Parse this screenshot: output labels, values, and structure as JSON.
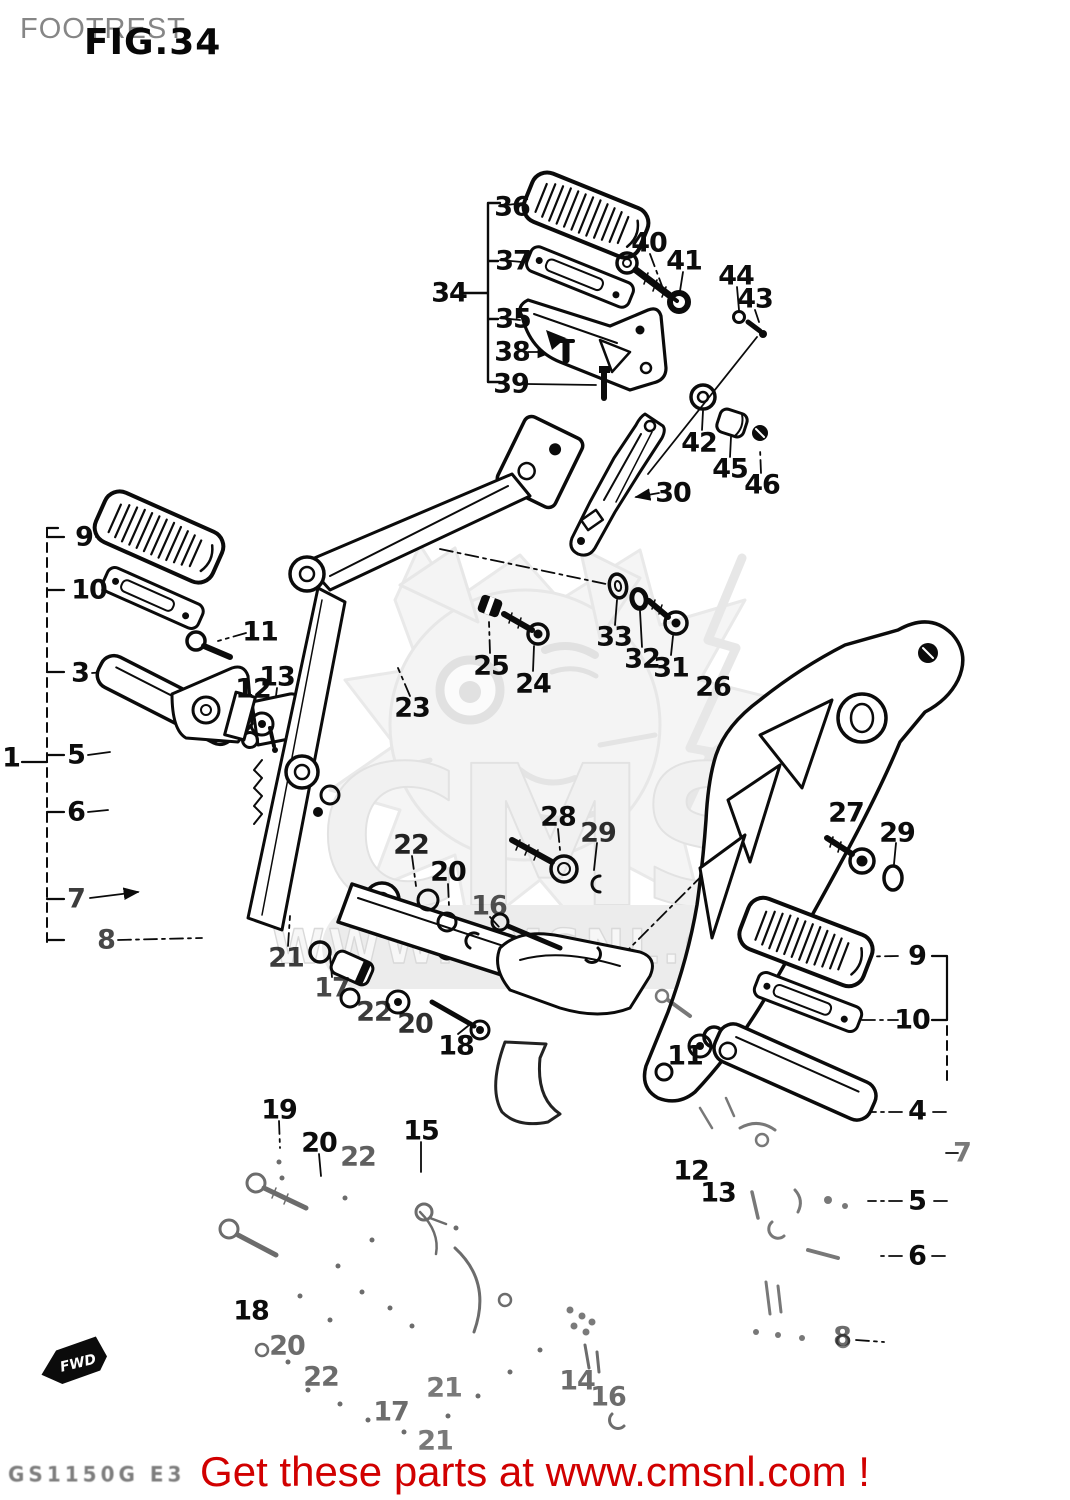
{
  "page": {
    "width": 1070,
    "height": 1500,
    "background": "#ffffff",
    "ink_color": "#0b0b0b"
  },
  "header": {
    "title": "FOOTREST",
    "figure": "FIG.34"
  },
  "watermark": {
    "logo_text": "CMS",
    "url_text": "WWW.CMSNL.COM",
    "color": "#e7e7e7"
  },
  "footer": {
    "fwd_label": "FWD",
    "model_code": "GS1150G E3",
    "promo_text": "Get these parts at www.cmsnl.com !",
    "promo_color": "#d10000"
  },
  "callouts": [
    {
      "label": "36",
      "x": 512,
      "y": 207,
      "o": 1
    },
    {
      "label": "37",
      "x": 513,
      "y": 261,
      "o": 1
    },
    {
      "label": "34",
      "x": 449,
      "y": 293,
      "o": 1
    },
    {
      "label": "35",
      "x": 513,
      "y": 319,
      "o": 1
    },
    {
      "label": "38",
      "x": 512,
      "y": 352,
      "o": 1
    },
    {
      "label": "39",
      "x": 511,
      "y": 384,
      "o": 1
    },
    {
      "label": "40",
      "x": 649,
      "y": 243,
      "o": 1
    },
    {
      "label": "41",
      "x": 684,
      "y": 261,
      "o": 1
    },
    {
      "label": "44",
      "x": 736,
      "y": 276,
      "o": 1
    },
    {
      "label": "43",
      "x": 755,
      "y": 299,
      "o": 1
    },
    {
      "label": "42",
      "x": 699,
      "y": 443,
      "o": 1
    },
    {
      "label": "45",
      "x": 730,
      "y": 469,
      "o": 1
    },
    {
      "label": "46",
      "x": 762,
      "y": 485,
      "o": 1
    },
    {
      "label": "30",
      "x": 673,
      "y": 493,
      "o": 1
    },
    {
      "label": "9",
      "x": 84,
      "y": 537,
      "o": 1
    },
    {
      "label": "10",
      "x": 89,
      "y": 590,
      "o": 1
    },
    {
      "label": "11",
      "x": 260,
      "y": 632,
      "o": 1
    },
    {
      "label": "3",
      "x": 80,
      "y": 673,
      "o": 1
    },
    {
      "label": "13",
      "x": 277,
      "y": 677,
      "o": 1
    },
    {
      "label": "12",
      "x": 253,
      "y": 689,
      "o": 1
    },
    {
      "label": "1",
      "x": 11,
      "y": 758,
      "o": 1
    },
    {
      "label": "5",
      "x": 76,
      "y": 755,
      "o": 1
    },
    {
      "label": "6",
      "x": 76,
      "y": 812,
      "o": 1
    },
    {
      "label": "7",
      "x": 76,
      "y": 899,
      "o": 0.8
    },
    {
      "label": "8",
      "x": 106,
      "y": 940,
      "o": 0.75
    },
    {
      "label": "23",
      "x": 412,
      "y": 708,
      "o": 1
    },
    {
      "label": "25",
      "x": 491,
      "y": 666,
      "o": 1
    },
    {
      "label": "24",
      "x": 533,
      "y": 684,
      "o": 1
    },
    {
      "label": "33",
      "x": 614,
      "y": 637,
      "o": 1
    },
    {
      "label": "32",
      "x": 642,
      "y": 659,
      "o": 1
    },
    {
      "label": "31",
      "x": 671,
      "y": 668,
      "o": 1
    },
    {
      "label": "26",
      "x": 713,
      "y": 687,
      "o": 1
    },
    {
      "label": "28",
      "x": 558,
      "y": 817,
      "o": 1
    },
    {
      "label": "29",
      "x": 598,
      "y": 833,
      "o": 0.85
    },
    {
      "label": "27",
      "x": 846,
      "y": 813,
      "o": 1
    },
    {
      "label": "29",
      "x": 897,
      "y": 833,
      "o": 1
    },
    {
      "label": "22",
      "x": 411,
      "y": 845,
      "o": 0.9
    },
    {
      "label": "20",
      "x": 448,
      "y": 872,
      "o": 1
    },
    {
      "label": "16",
      "x": 489,
      "y": 906,
      "o": 0.7
    },
    {
      "label": "21",
      "x": 286,
      "y": 958,
      "o": 0.8
    },
    {
      "label": "17",
      "x": 332,
      "y": 988,
      "o": 0.75
    },
    {
      "label": "22",
      "x": 374,
      "y": 1012,
      "o": 0.8
    },
    {
      "label": "20",
      "x": 415,
      "y": 1024,
      "o": 0.85
    },
    {
      "label": "18",
      "x": 456,
      "y": 1046,
      "o": 1
    },
    {
      "label": "19",
      "x": 279,
      "y": 1110,
      "o": 1
    },
    {
      "label": "20",
      "x": 319,
      "y": 1143,
      "o": 1
    },
    {
      "label": "15",
      "x": 421,
      "y": 1131,
      "o": 1
    },
    {
      "label": "22",
      "x": 358,
      "y": 1157,
      "o": 0.65
    },
    {
      "label": "18",
      "x": 251,
      "y": 1311,
      "o": 1
    },
    {
      "label": "20",
      "x": 287,
      "y": 1346,
      "o": 0.6
    },
    {
      "label": "22",
      "x": 321,
      "y": 1377,
      "o": 0.6
    },
    {
      "label": "17",
      "x": 391,
      "y": 1412,
      "o": 0.6
    },
    {
      "label": "21",
      "x": 444,
      "y": 1388,
      "o": 0.55
    },
    {
      "label": "21",
      "x": 435,
      "y": 1441,
      "o": 0.55
    },
    {
      "label": "14",
      "x": 577,
      "y": 1381,
      "o": 0.6
    },
    {
      "label": "16",
      "x": 608,
      "y": 1397,
      "o": 0.6
    },
    {
      "label": "9",
      "x": 917,
      "y": 956,
      "o": 1
    },
    {
      "label": "10",
      "x": 912,
      "y": 1020,
      "o": 1
    },
    {
      "label": "11",
      "x": 685,
      "y": 1056,
      "o": 1
    },
    {
      "label": "4",
      "x": 917,
      "y": 1111,
      "o": 1
    },
    {
      "label": "7",
      "x": 962,
      "y": 1153,
      "o": 0.55
    },
    {
      "label": "12",
      "x": 691,
      "y": 1171,
      "o": 1
    },
    {
      "label": "13",
      "x": 718,
      "y": 1193,
      "o": 1
    },
    {
      "label": "5",
      "x": 917,
      "y": 1201,
      "o": 1
    },
    {
      "label": "6",
      "x": 917,
      "y": 1256,
      "o": 1
    },
    {
      "label": "8",
      "x": 842,
      "y": 1337,
      "o": 0.6
    }
  ]
}
